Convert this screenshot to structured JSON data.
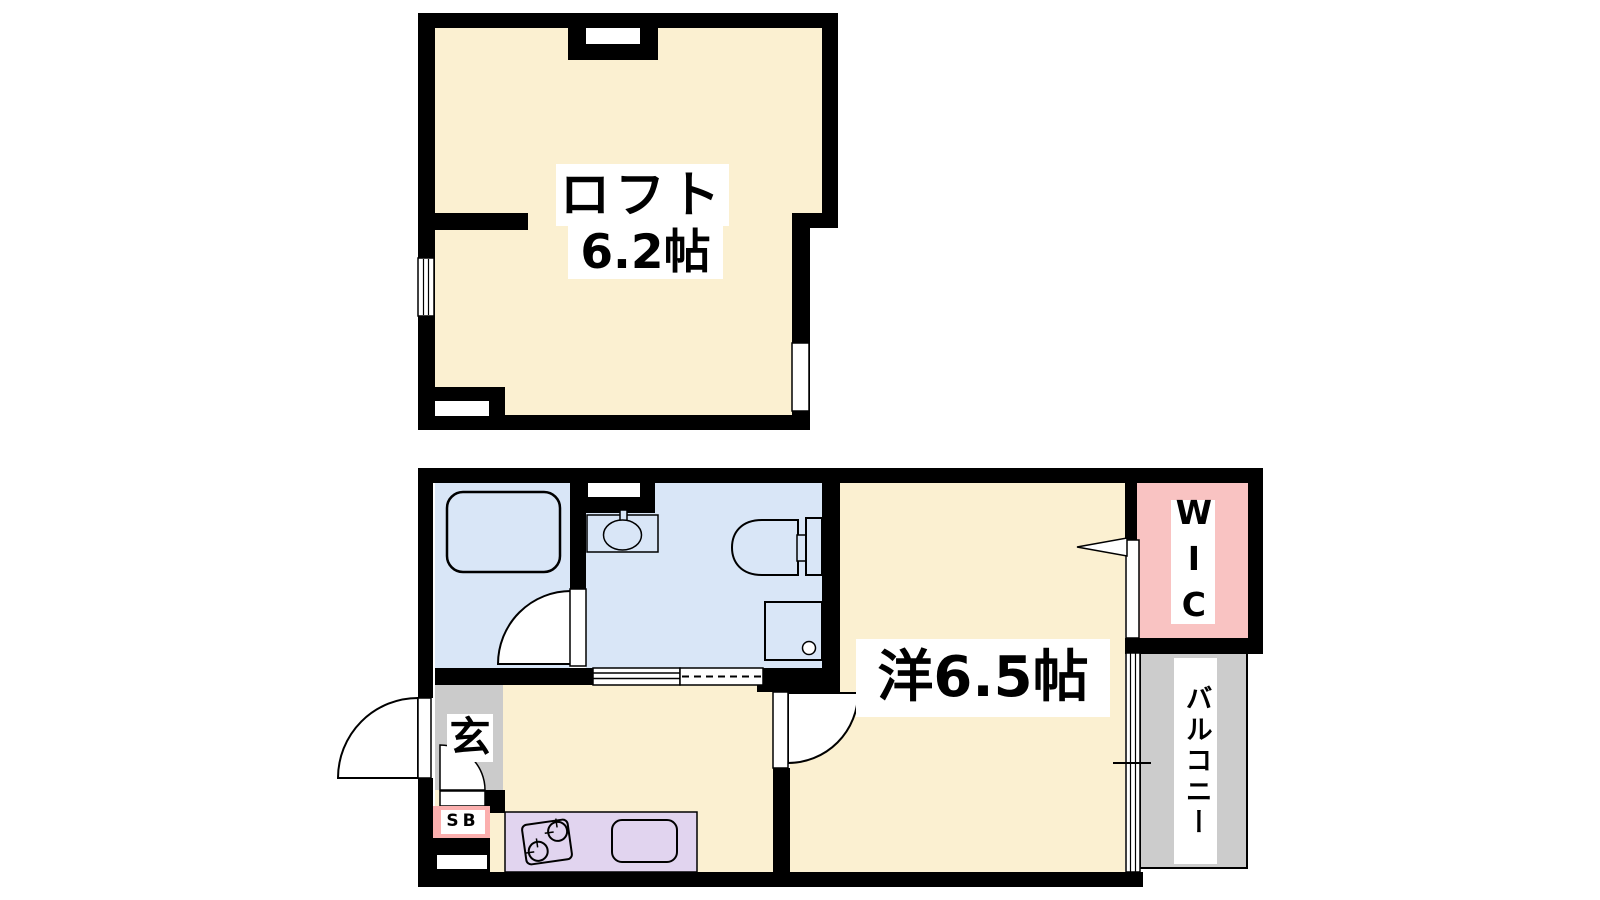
{
  "document": {
    "kind": "apartment-floor-plan"
  },
  "colors": {
    "wall": "#000000",
    "room_cream": "#FBF0D1",
    "wet_blue": "#D9E6F7",
    "wic_pink": "#F9C3C2",
    "sb_pink": "#FBAFAE",
    "kitchen_purple": "#E1D4EF",
    "entry_gray": "#CBCBCB",
    "balcony_gray": "#CCCCCC"
  },
  "loft": {
    "name_label": "ロフト",
    "size_label": "6.2帖"
  },
  "main_floor": {
    "room_label": "洋6.5帖",
    "entrance_label": "玄",
    "shoe_box_label": "SB",
    "wic_label": "WIC",
    "balcony_label": "バルコニー"
  }
}
